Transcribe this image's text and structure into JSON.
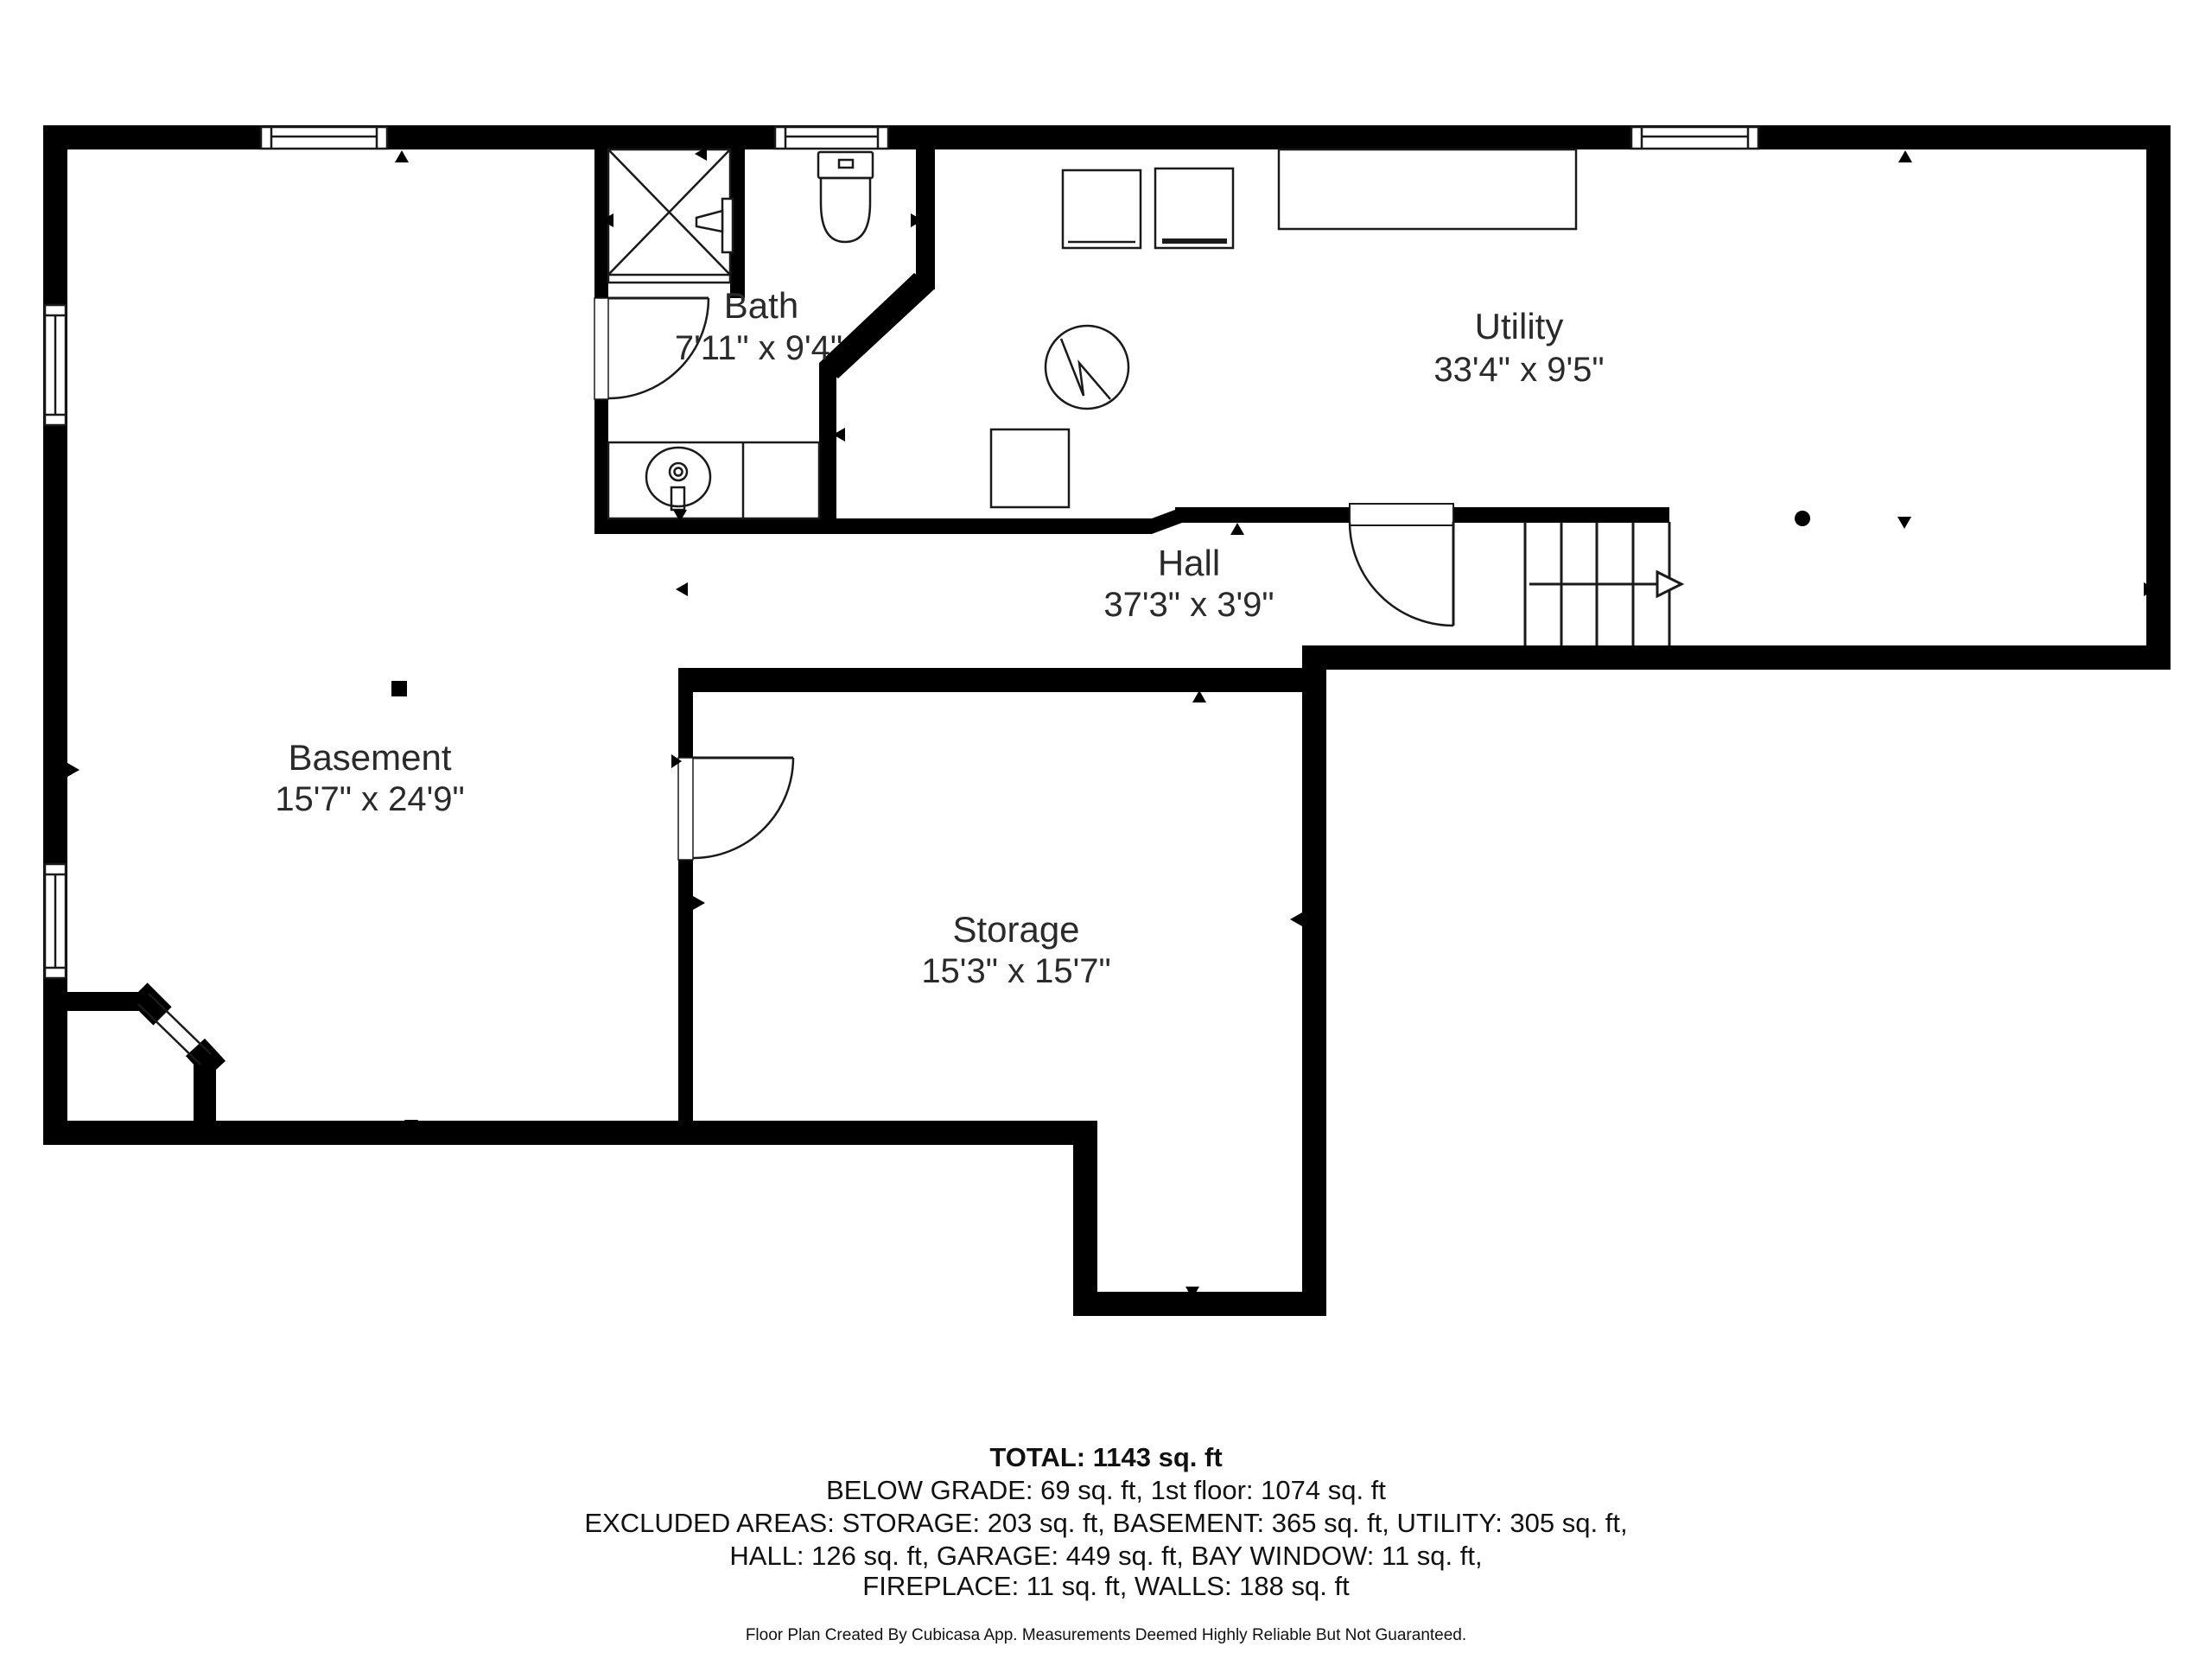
{
  "plan": {
    "rooms": [
      {
        "name": "Bath",
        "dims": "7'11\" x 9'4\""
      },
      {
        "name": "Utility",
        "dims": "33'4\" x 9'5\""
      },
      {
        "name": "Hall",
        "dims": "37'3\" x 3'9\""
      },
      {
        "name": "Basement",
        "dims": "15'7\" x 24'9\""
      },
      {
        "name": "Storage",
        "dims": "15'3\" x 15'7\""
      }
    ],
    "fixtures": [
      "shower",
      "toilet",
      "sink-vanity",
      "washer",
      "dryer",
      "countertop",
      "furnace",
      "water-heater",
      "stairs",
      "doors",
      "windows"
    ],
    "colors": {
      "wall": "#000000",
      "line": "#1a1a1a",
      "text": "#2a2a2a",
      "background": "#ffffff"
    }
  },
  "summary": {
    "total": "TOTAL: 1143 sq. ft",
    "line1": "BELOW GRADE: 69 sq. ft, 1st floor: 1074 sq. ft",
    "line2": "EXCLUDED AREAS: STORAGE: 203 sq. ft, BASEMENT: 365 sq. ft, UTILITY: 305 sq. ft,",
    "line3": "HALL: 126 sq. ft, GARAGE: 449 sq. ft, BAY WINDOW: 11 sq. ft,",
    "line4": "FIREPLACE: 11 sq. ft, WALLS: 188 sq. ft"
  },
  "footer": "Floor Plan Created By Cubicasa App. Measurements Deemed Highly Reliable But Not Guaranteed."
}
